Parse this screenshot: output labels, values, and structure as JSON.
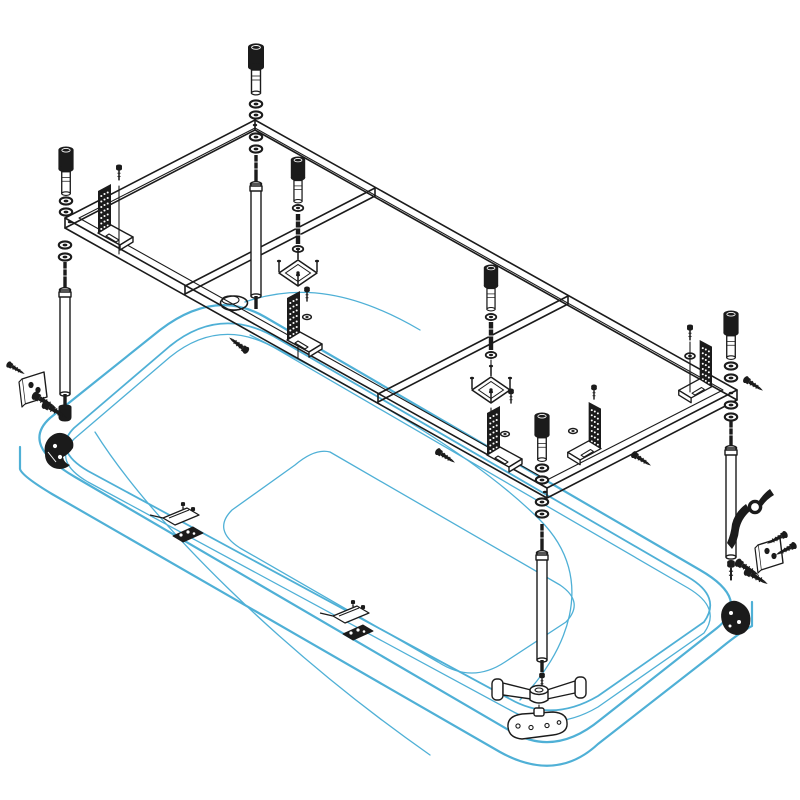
{
  "figure": {
    "alt": "Exploded isometric assembly diagram of a rectangular bathtub with a steel support frame, adjustable legs, bolts, washers, brackets and fixing hardware"
  },
  "colors": {
    "background": "#ffffff",
    "line": "#1b1b1b",
    "tub": "#4fb0d6"
  },
  "parts": {
    "frame": "Support frame",
    "bathtub": "Bathtub",
    "drain": "Drain opening",
    "leg": "Adjustable leg",
    "bolt": "Socket head cap screw",
    "washer": "Washer",
    "stud": "Threaded stud",
    "bracket": "Perforated angle bracket",
    "fixing_plate": "Square fixing plate",
    "wall_bracket": "Wall anchor bracket",
    "wall_screw": "Anchor screw",
    "rim_clip": "Apron mounting clip",
    "panel_foot": "Front panel support foot",
    "foot_plate": "Panel foot base plate",
    "corner_pad": "Corner support pad",
    "handle": "Locking lever"
  },
  "quantities": {
    "adjustable_legs": 4,
    "cap_screws": 6,
    "angle_brackets": 5,
    "fixing_plates": 2,
    "wall_brackets": 2,
    "apron_clips": 2,
    "corner_pads": 2
  }
}
